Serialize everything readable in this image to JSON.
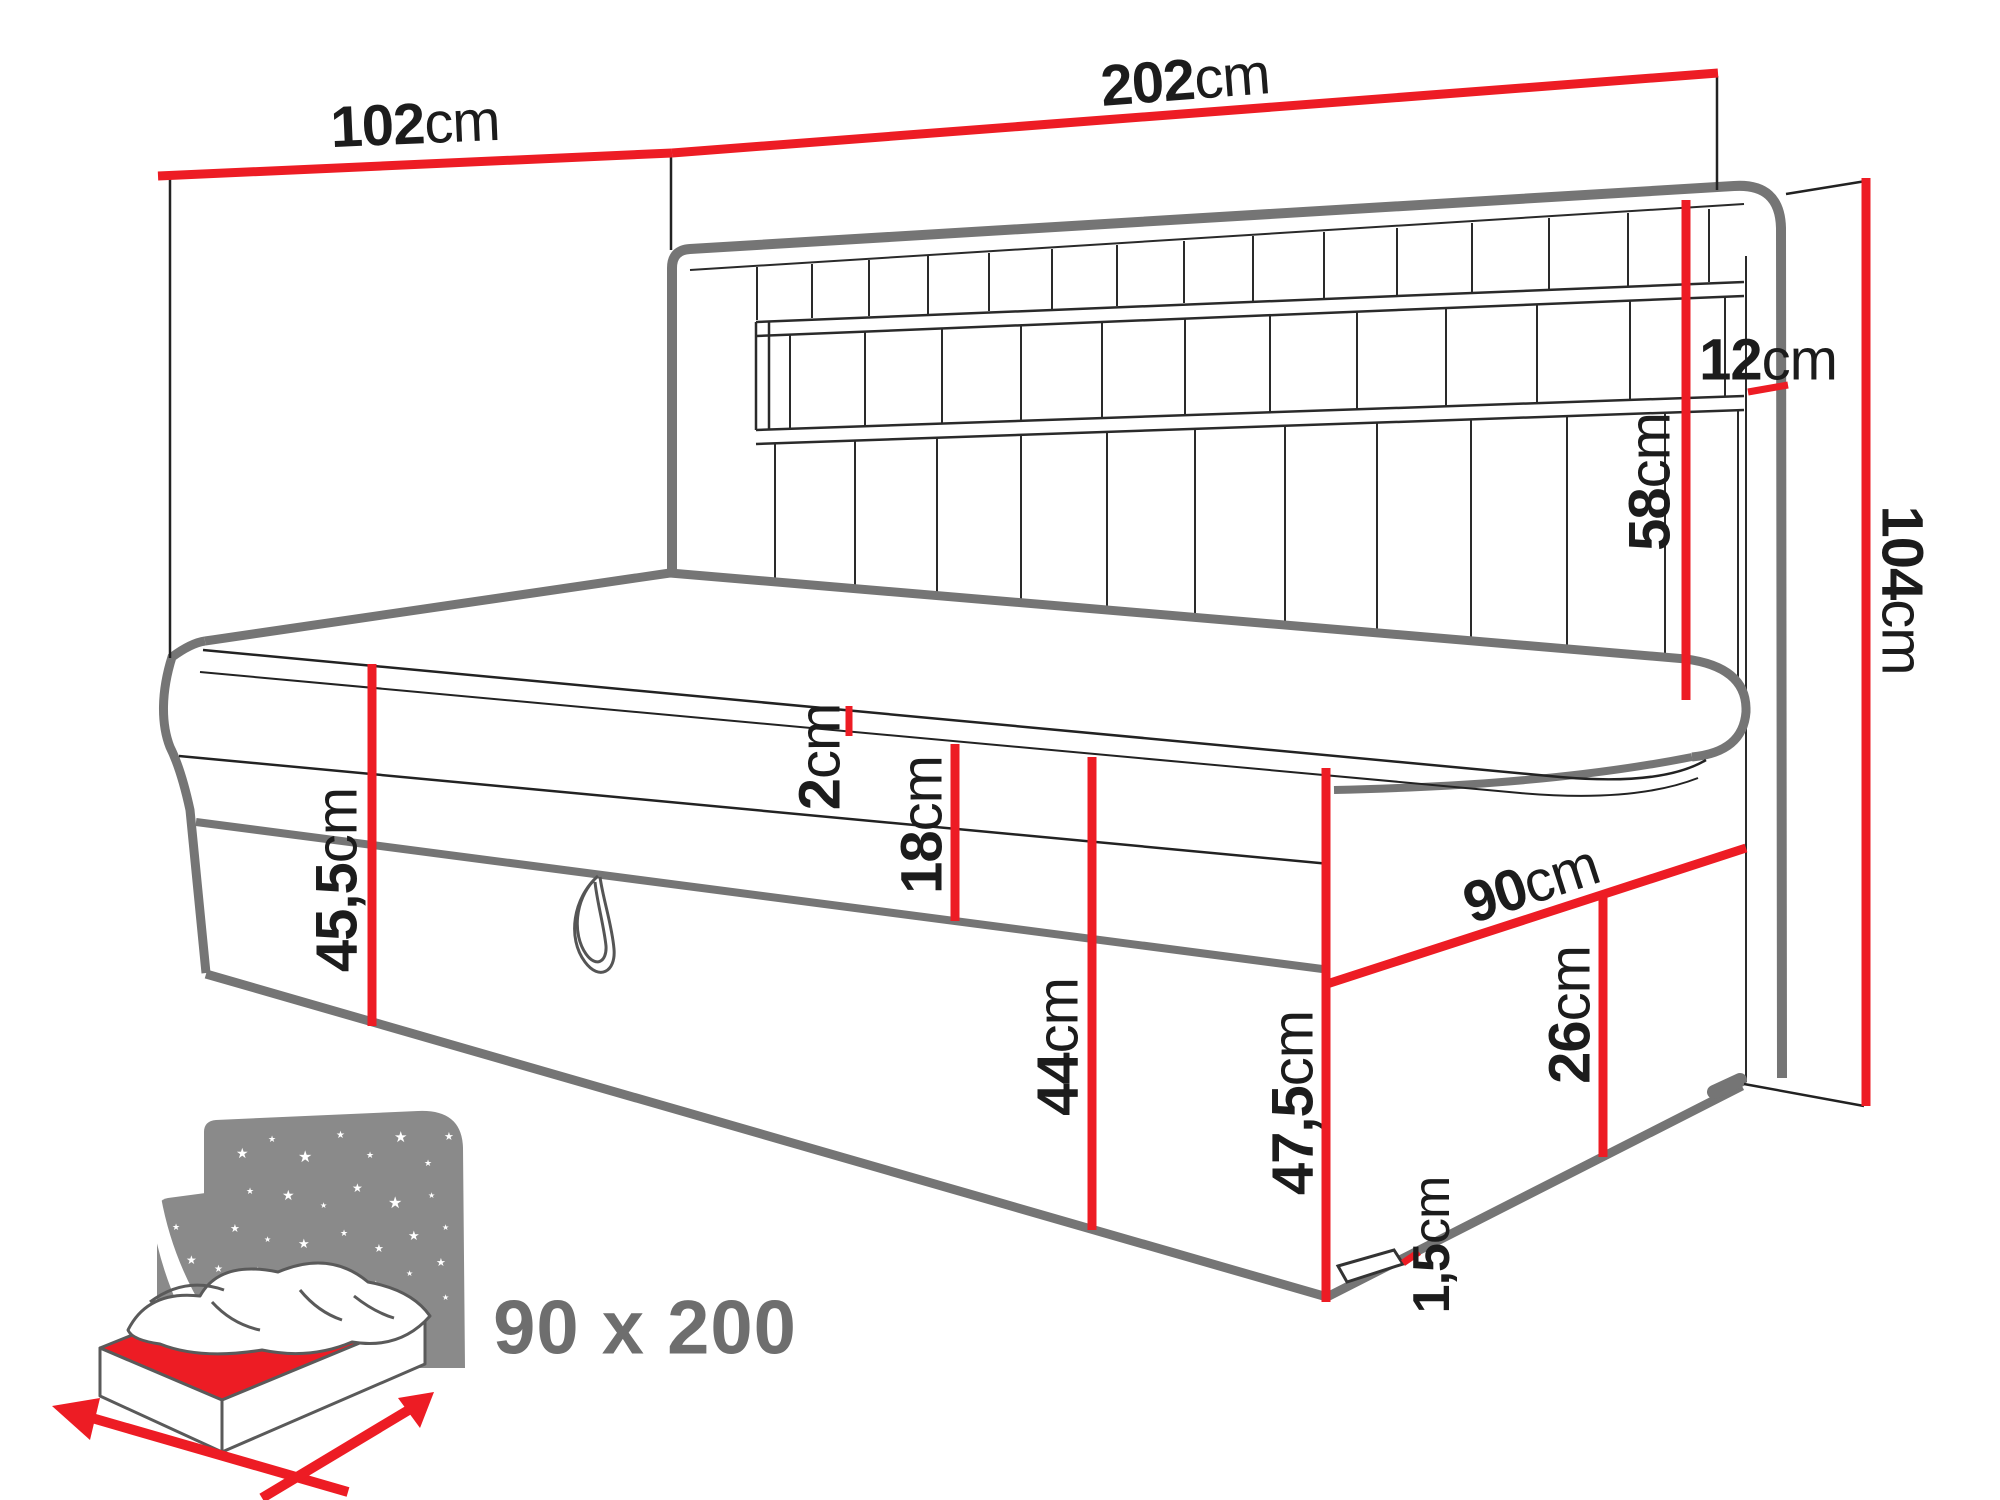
{
  "diagram": {
    "type": "bed-technical-drawing",
    "unit": "cm",
    "dimensions": {
      "d102": {
        "value": "102",
        "unit": "cm"
      },
      "d202": {
        "value": "202",
        "unit": "cm"
      },
      "d12": {
        "value": "12",
        "unit": "cm"
      },
      "d58": {
        "value": "58",
        "unit": "cm"
      },
      "d104": {
        "value": "104",
        "unit": "cm"
      },
      "d2": {
        "value": "2",
        "unit": "cm"
      },
      "d18": {
        "value": "18",
        "unit": "cm"
      },
      "d45_5": {
        "value": "45,5",
        "unit": "cm"
      },
      "d44": {
        "value": "44",
        "unit": "cm"
      },
      "d90": {
        "value": "90",
        "unit": "cm"
      },
      "d26": {
        "value": "26",
        "unit": "cm"
      },
      "d47_5": {
        "value": "47,5",
        "unit": "cm"
      },
      "d1_5": {
        "value": "1,5",
        "unit": "cm"
      }
    },
    "icon": {
      "label": "90 x 200"
    },
    "colors": {
      "dimension_red": "#ed1c24",
      "line_gray": "#757575",
      "line_black": "#222222",
      "text_black": "#1c1c1c",
      "icon_gray": "#8a8a8a",
      "label_gray": "#6e6e6e"
    }
  }
}
